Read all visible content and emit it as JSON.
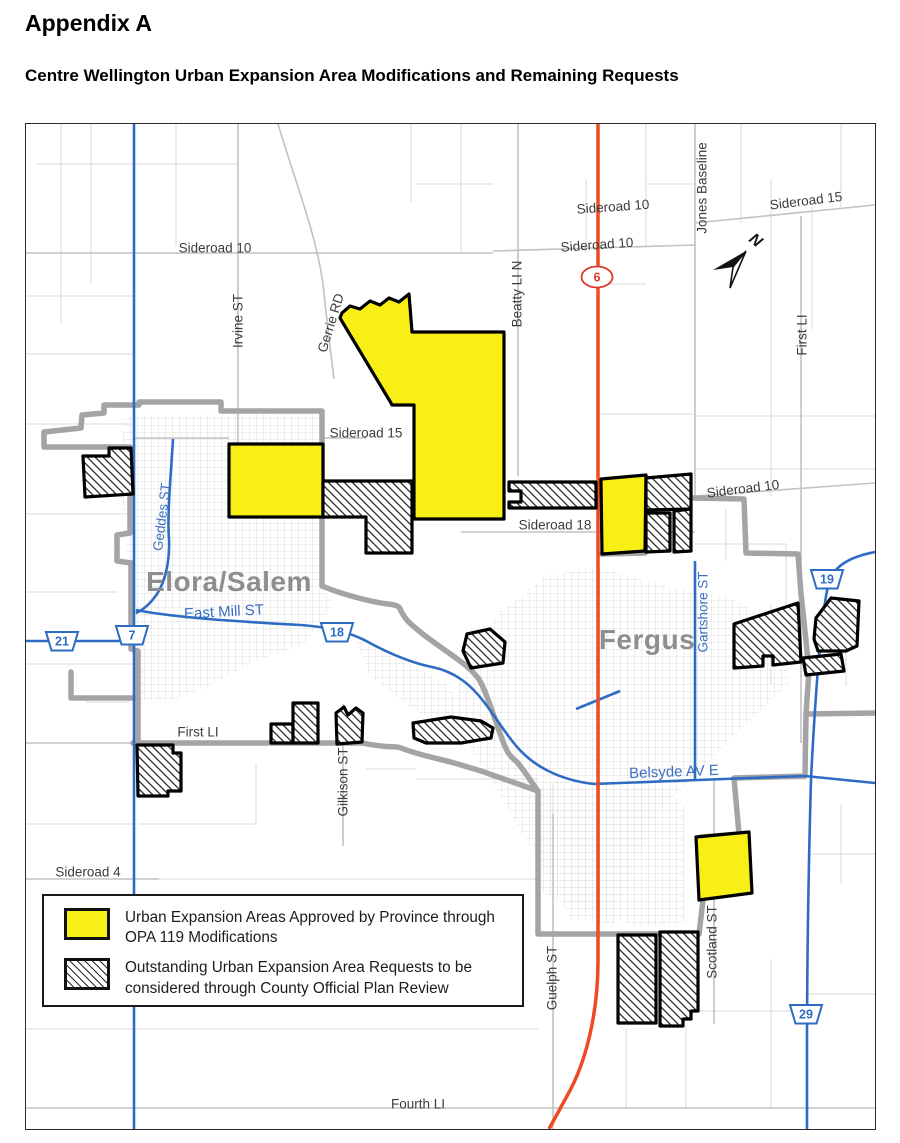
{
  "page": {
    "title": "Appendix A",
    "subtitle": "Centre Wellington Urban Expansion Area Modifications and Remaining Requests"
  },
  "map": {
    "north_label": "N",
    "cities": [
      {
        "name": "Elora/Salem"
      },
      {
        "name": "Fergus"
      }
    ],
    "road_labels": [
      {
        "text": "Sideroad 10"
      },
      {
        "text": "Sideroad 10"
      },
      {
        "text": "Sideroad 15"
      },
      {
        "text": "Jones Baseline"
      },
      {
        "text": "Irvine ST"
      },
      {
        "text": "Gerrie RD"
      },
      {
        "text": "Beatty LI N"
      },
      {
        "text": "Sideroad 10"
      },
      {
        "text": "First LI"
      },
      {
        "text": "Sideroad 15"
      },
      {
        "text": "Geddes ST"
      },
      {
        "text": "East Mill ST"
      },
      {
        "text": "Sideroad 18"
      },
      {
        "text": "Sideroad 10"
      },
      {
        "text": "Gartshore ST"
      },
      {
        "text": "First LI"
      },
      {
        "text": "Gilkison ST"
      },
      {
        "text": "Sideroad 4"
      },
      {
        "text": "Belsyde AV E"
      },
      {
        "text": "Scotland ST"
      },
      {
        "text": "Guelph ST"
      },
      {
        "text": "Fourth LI"
      }
    ],
    "route_shields": [
      {
        "number": "6",
        "type": "provincial-highway"
      },
      {
        "number": "21",
        "type": "county-road"
      },
      {
        "number": "7",
        "type": "county-road"
      },
      {
        "number": "18",
        "type": "county-road"
      },
      {
        "number": "19",
        "type": "county-road"
      },
      {
        "number": "29",
        "type": "county-road"
      }
    ],
    "legend": {
      "items": [
        {
          "swatch": "yellow-fill",
          "label": "Urban Expansion Areas Approved by Province through OPA 119 Modifications"
        },
        {
          "swatch": "diagonal-hatch",
          "label": "Outstanding Urban Expansion Area Requests to be considered through County Official Plan Review"
        }
      ]
    },
    "colors": {
      "approved_fill": "#f8ef17",
      "urban_boundary_gray": "#a4a4a4",
      "road_water_blue": "#2e6cc4",
      "highway_red": "#ee4a23"
    }
  }
}
